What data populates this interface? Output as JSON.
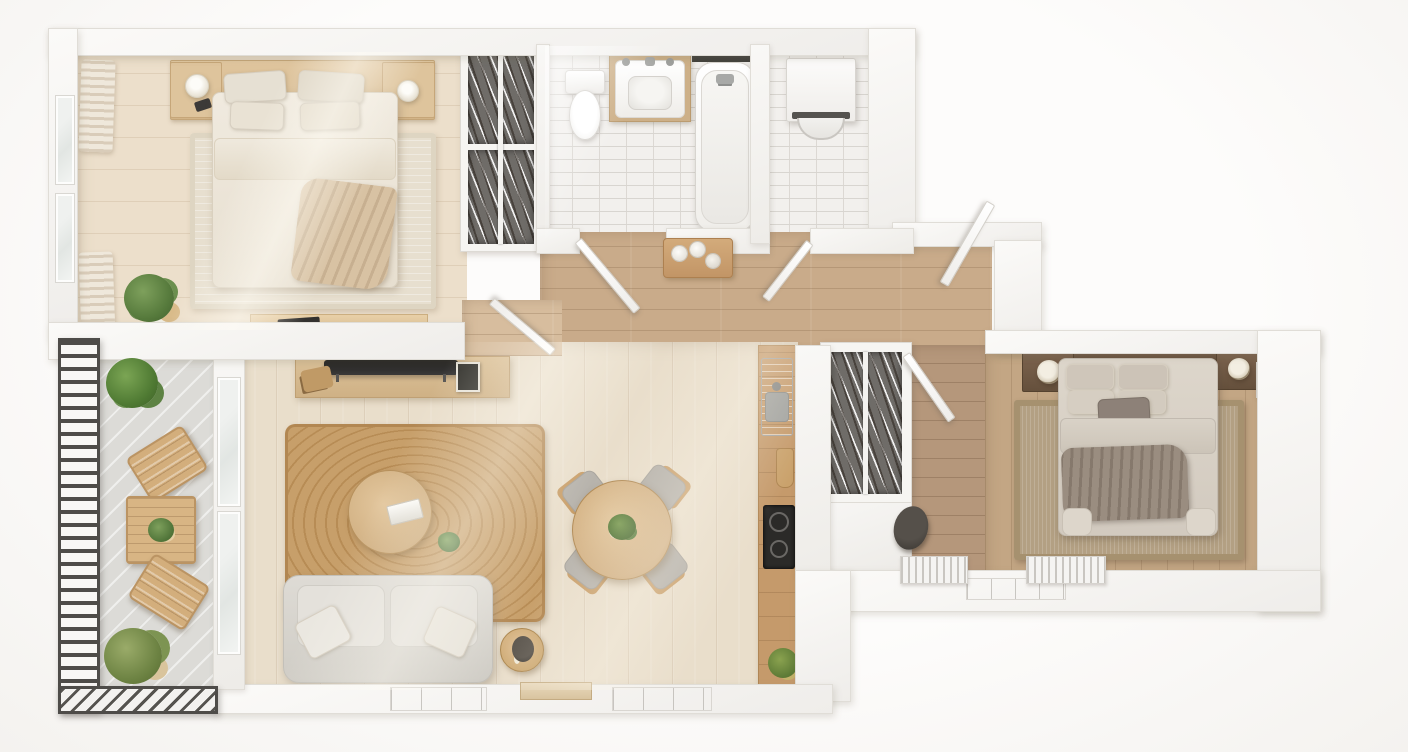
{
  "scene": {
    "kind": "apartment-floor-plan-3d-top-view",
    "style": "scandinavian-neutral",
    "labels_visible": false
  },
  "palette": {
    "wall_white": "#f7f5f2",
    "floor_pale_wood": "#e9decb",
    "floor_tan_wood": "#c9ab8a",
    "floor_entry_wood": "#b5977b",
    "floor_bedroom2_wood": "#c3a684",
    "bathroom_tile": "#f2f0ed",
    "balcony_concrete": "#dcdbd7",
    "jute_rug": "#c79f6a",
    "sofa_gray": "#d9d6d0",
    "wood_furniture": "#d4b184",
    "dark_wood": "#6e5643",
    "railing_dark": "#4e4c49",
    "cooktop_black": "#2b2a28",
    "plant_green": "#5f8344"
  },
  "rooms": [
    {
      "id": "bedroom-1",
      "label": "Bedroom 1",
      "furniture": [
        "double-bed",
        "headboard-shelf",
        "nightstand-left",
        "nightstand-right",
        "table-lamp-left",
        "table-lamp-right",
        "pillows",
        "duvet",
        "throw-blanket",
        "area-rug",
        "desk",
        "laptop",
        "potted-plant",
        "curtains",
        "window"
      ]
    },
    {
      "id": "walk-in-wardrobe",
      "label": "Walk-in wardrobe",
      "furniture": [
        "hanging-clothes-upper",
        "hanging-clothes-lower",
        "clothes-rail"
      ]
    },
    {
      "id": "bathroom",
      "label": "Bathroom",
      "furniture": [
        "toilet",
        "vanity-sink",
        "faucets",
        "bathtub",
        "tub-faucet",
        "wall-niche"
      ]
    },
    {
      "id": "laundry-closet",
      "label": "Laundry closet",
      "furniture": [
        "washing-machine"
      ]
    },
    {
      "id": "hallway",
      "label": "Hallway",
      "furniture": [
        "bench-with-towels",
        "bathroom-door",
        "laundry-door",
        "corridor-door",
        "bedroom1-door"
      ]
    },
    {
      "id": "living-room",
      "label": "Living room",
      "furniture": [
        "sofa",
        "sofa-pillows",
        "jute-rug",
        "coffee-table",
        "tv-console",
        "television",
        "photo-frame",
        "side-table",
        "table-lamp",
        "bottom-windows"
      ]
    },
    {
      "id": "dining-area",
      "label": "Dining area",
      "furniture": [
        "round-table",
        "chair-nw",
        "chair-ne",
        "chair-sw",
        "chair-se",
        "centerpiece-plant"
      ]
    },
    {
      "id": "kitchen",
      "label": "Kitchen",
      "furniture": [
        "counter",
        "sink",
        "cutting-board",
        "cooktop",
        "potted-plant"
      ]
    },
    {
      "id": "entry-hall",
      "label": "Entry hall",
      "furniture": [
        "coat-closet",
        "stool",
        "radiator-left",
        "radiator-right",
        "bedroom2-door",
        "window"
      ]
    },
    {
      "id": "bedroom-2",
      "label": "Bedroom 2",
      "furniture": [
        "double-bed",
        "headboard",
        "nightstand-left",
        "nightstand-right",
        "round-lamp-left",
        "round-lamp-right",
        "pillows",
        "accent-pillow",
        "throw-blanket",
        "area-rug",
        "wall-radiator"
      ]
    },
    {
      "id": "balcony",
      "label": "Balcony",
      "furniture": [
        "railing-left",
        "railing-bottom",
        "outdoor-table",
        "outdoor-chair-top",
        "outdoor-chair-bottom",
        "plant-top",
        "plant-bottom",
        "glass-partition"
      ]
    }
  ]
}
